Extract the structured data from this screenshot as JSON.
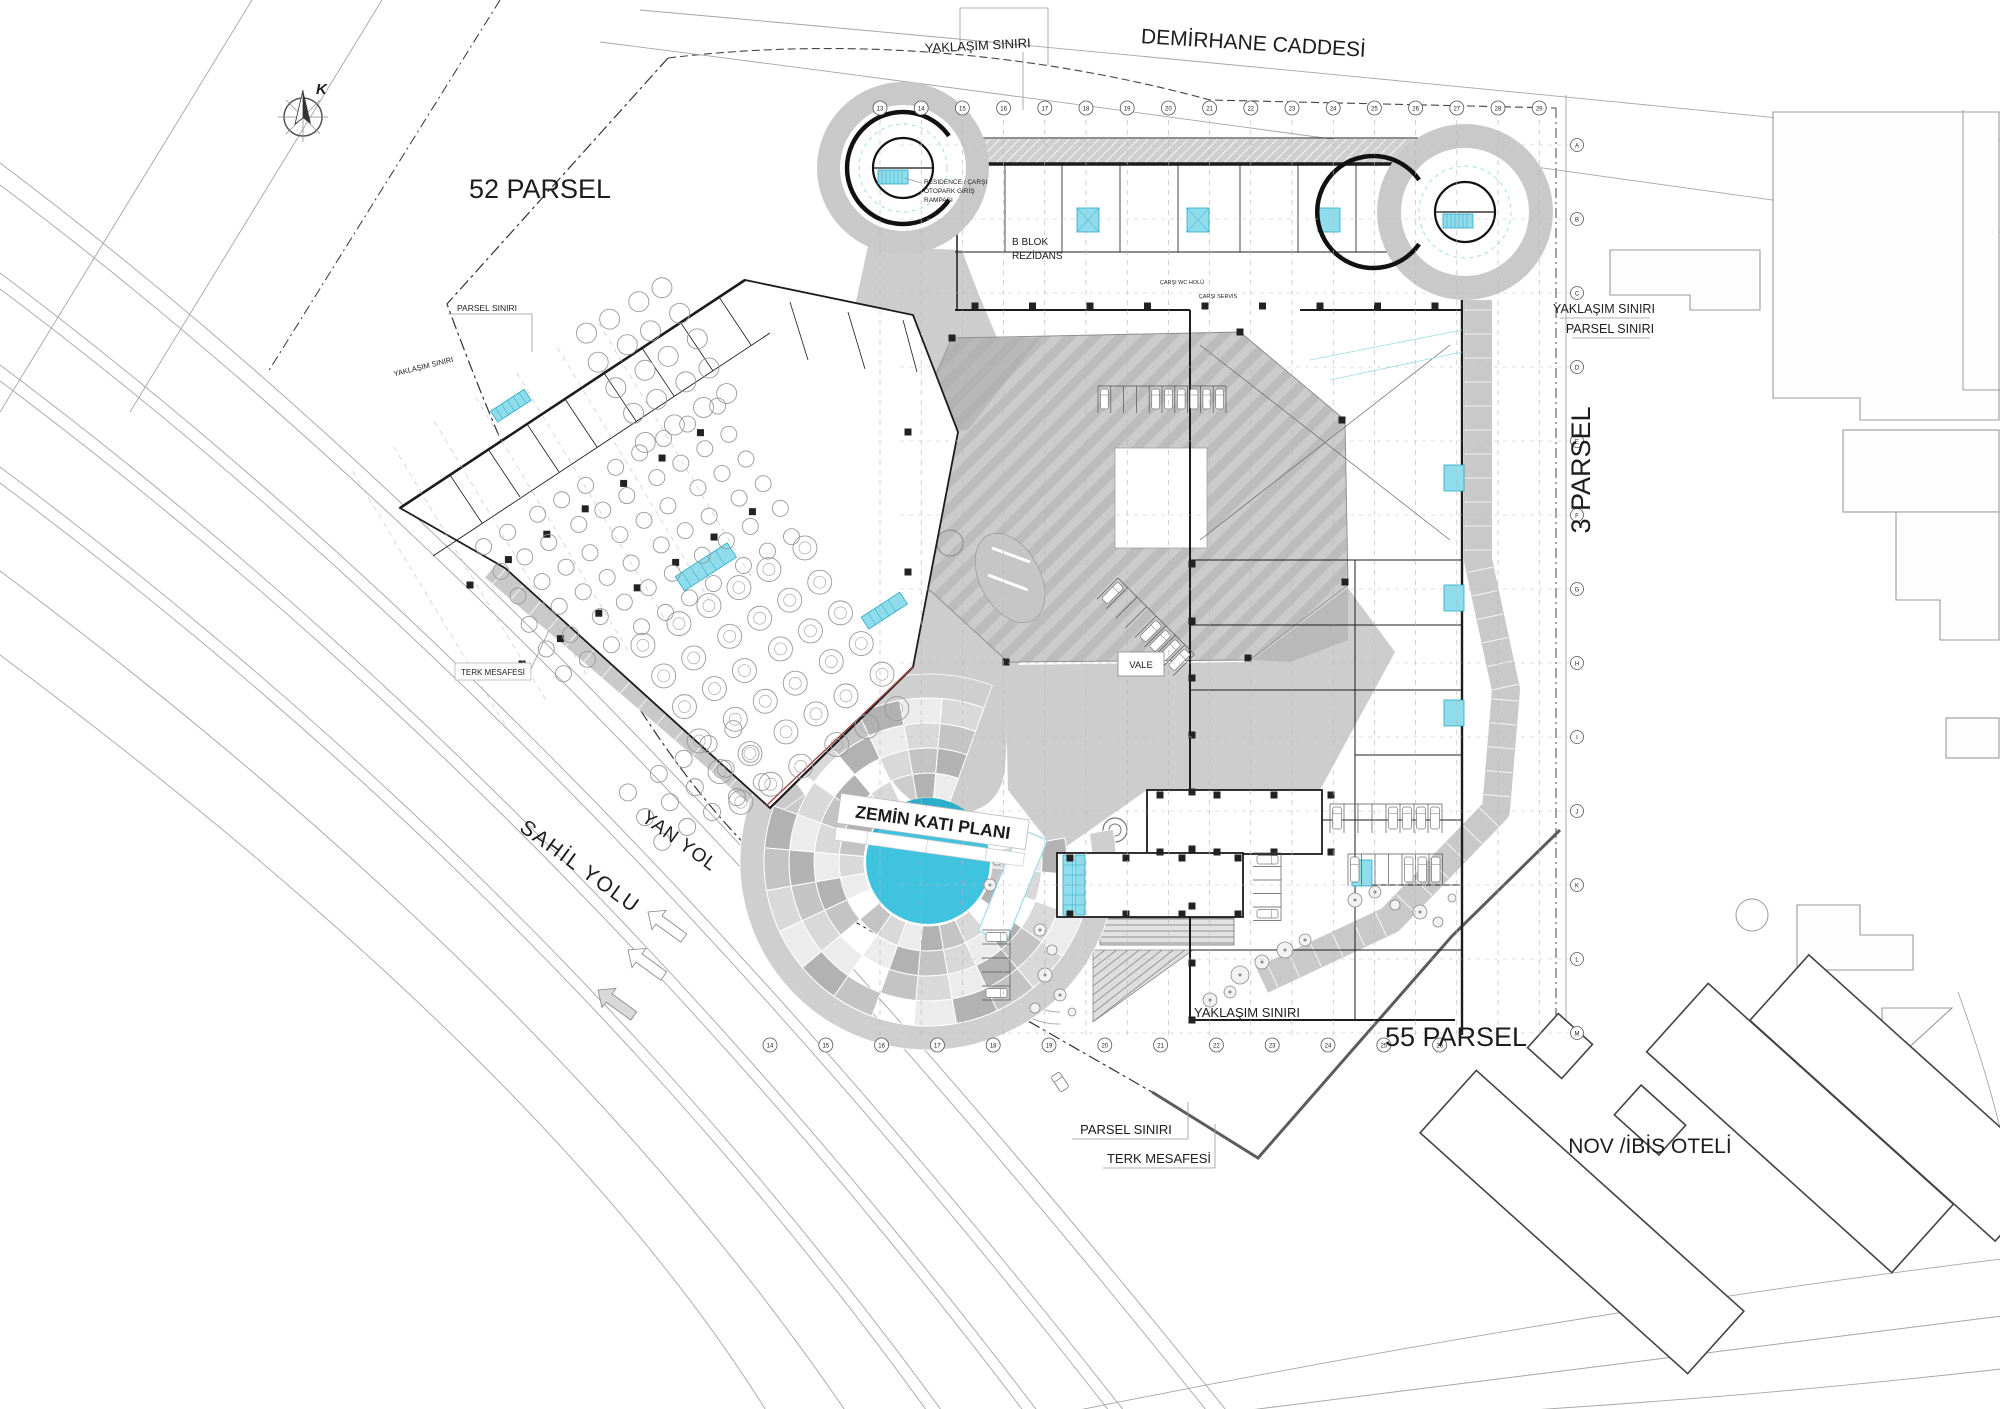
{
  "compass": {
    "north_label": "K"
  },
  "streets": {
    "demirhane": "DEMİRHANE CADDESİ",
    "sahil_yolu": "SAHİL YOLU",
    "yan_yol": "YAN YOL"
  },
  "parcels": {
    "parsel_52": "52 PARSEL",
    "parsel_3": "3 PARSEL",
    "parsel_55": "55 PARSEL",
    "hotel": "NOV /İBİS OTELİ"
  },
  "boundaries": {
    "yaklasim_siniri": "YAKLAŞIM SINIRI",
    "parsel_siniri": "PARSEL SINIRI",
    "terk_mesafesi": "TERK MESAFESİ"
  },
  "building": {
    "plan_title": "ZEMİN KATI PLANI",
    "b_blok": "B BLOK",
    "rezidans": "REZİDANS",
    "vale": "VALE",
    "ramp_note_1": "RESIDENCE / ÇARŞI",
    "ramp_note_2": "OTOPARK GİRİŞ",
    "ramp_note_3": "RAMPASI",
    "carsi_wc": "ÇARŞI WC HOLÜ",
    "carsi_servis": "ÇARŞI SERVİS"
  },
  "grid": {
    "top_numbers": [
      "13",
      "14",
      "15",
      "16",
      "17",
      "18",
      "19",
      "20",
      "21",
      "22",
      "23",
      "24",
      "25",
      "26",
      "27",
      "28",
      "29"
    ],
    "bottom_numbers": [
      "14",
      "15",
      "16",
      "17",
      "18",
      "19",
      "20",
      "21",
      "22",
      "23",
      "24",
      "25",
      "26"
    ],
    "right_letters": [
      "A",
      "B",
      "C",
      "D",
      "E",
      "F",
      "G",
      "H",
      "I",
      "J",
      "K",
      "L",
      "M"
    ]
  },
  "colors": {
    "accent_cyan": "#3fc3de",
    "cyan_light": "#9adceb",
    "escalator_cyan": "#8fdcec",
    "gray_plaza": "#cdcdcd",
    "gray_band": "#c9c9c9",
    "line_dark": "#1c1c1c"
  }
}
